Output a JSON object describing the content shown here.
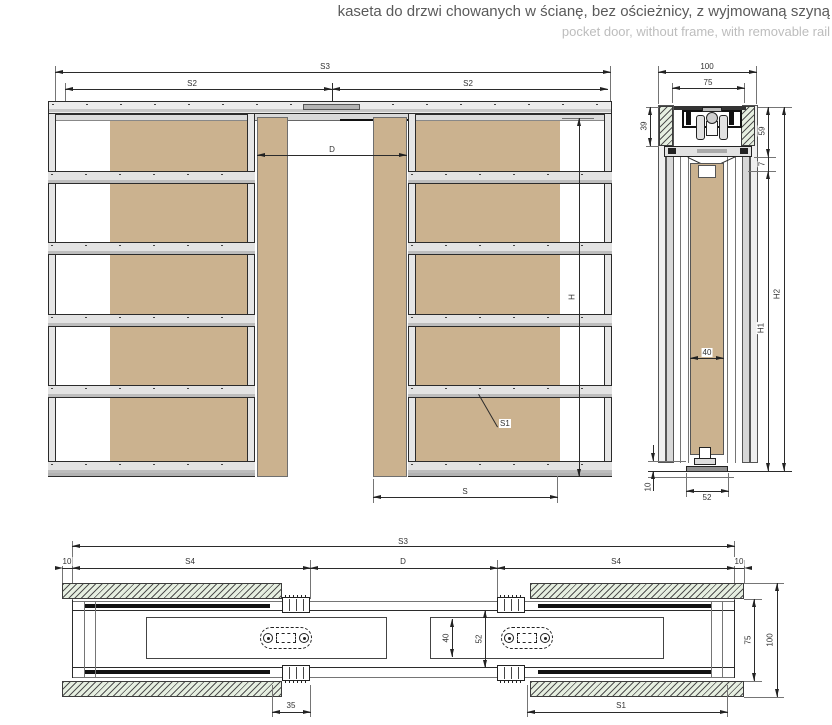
{
  "header": {
    "title_pl": "kaseta do drzwi chowanych w ścianę, bez ościeżnicy, z wyjmowaną szyną",
    "title_en": "pocket door, without frame, with removable rail"
  },
  "front_view": {
    "description": "front elevation of double pocket-door cassette",
    "dims": {
      "s3": "S3",
      "s2_left": "S2",
      "s2_right": "S2",
      "d": "D",
      "h": "H",
      "s": "S",
      "s1_leader": "S1"
    }
  },
  "side_view": {
    "description": "vertical cross-section through wall and rail",
    "dims": {
      "overall_width": "100",
      "inner_width": "75",
      "track_left": "39",
      "track_right": "59",
      "clearance": "7",
      "door_thickness": "40",
      "h1": "H1",
      "h2": "H2",
      "floor_guide_width": "52",
      "floor_gap": "10"
    }
  },
  "plan_view": {
    "description": "horizontal section through cassette wall",
    "dims": {
      "s3": "S3",
      "overhang_left": "10",
      "s4_left": "S4",
      "d": "D",
      "s4_right": "S4",
      "overhang_right": "10",
      "door_thickness": "40",
      "pocket_width": "52",
      "wall_inner": "75",
      "wall_overall": "100",
      "jamb_width": "35",
      "s1": "S1"
    }
  },
  "colors": {
    "panel_tan": "#cbb28f",
    "rail_gray": "#e3e3e3",
    "hatch_green": "#e6efe1",
    "line": "#2b2b2b",
    "title": "#5a5a5a",
    "subtitle": "#bdbdbd"
  }
}
